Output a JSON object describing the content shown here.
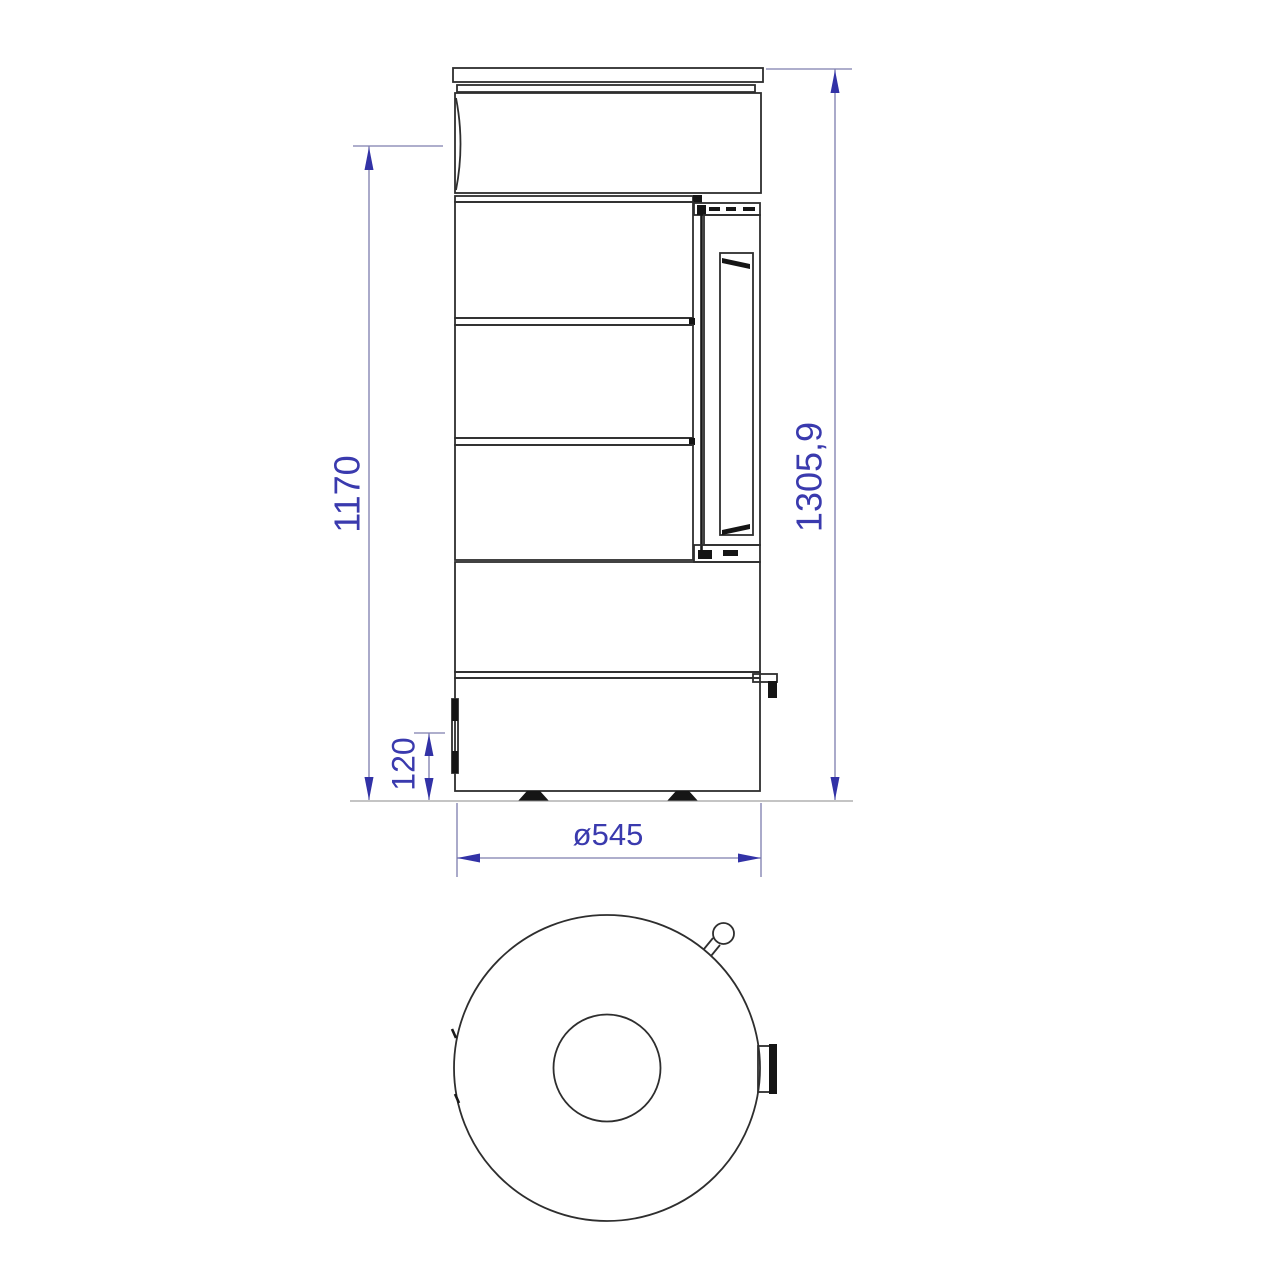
{
  "drawing": {
    "type": "technical-dimension-drawing",
    "subject": "cylindrical-stove",
    "views": {
      "side_view": "front-side elevation with door and stacked drum sections",
      "top_view": "plan view with flue outlet, door handle and latch"
    },
    "colors": {
      "line": "#2e2e2e",
      "dimension": "#3a3aae",
      "background": "#ffffff"
    },
    "dimensions": {
      "body_height": "1170",
      "total_height": "1305,9",
      "base_height": "120",
      "diameter": "ø545"
    }
  }
}
